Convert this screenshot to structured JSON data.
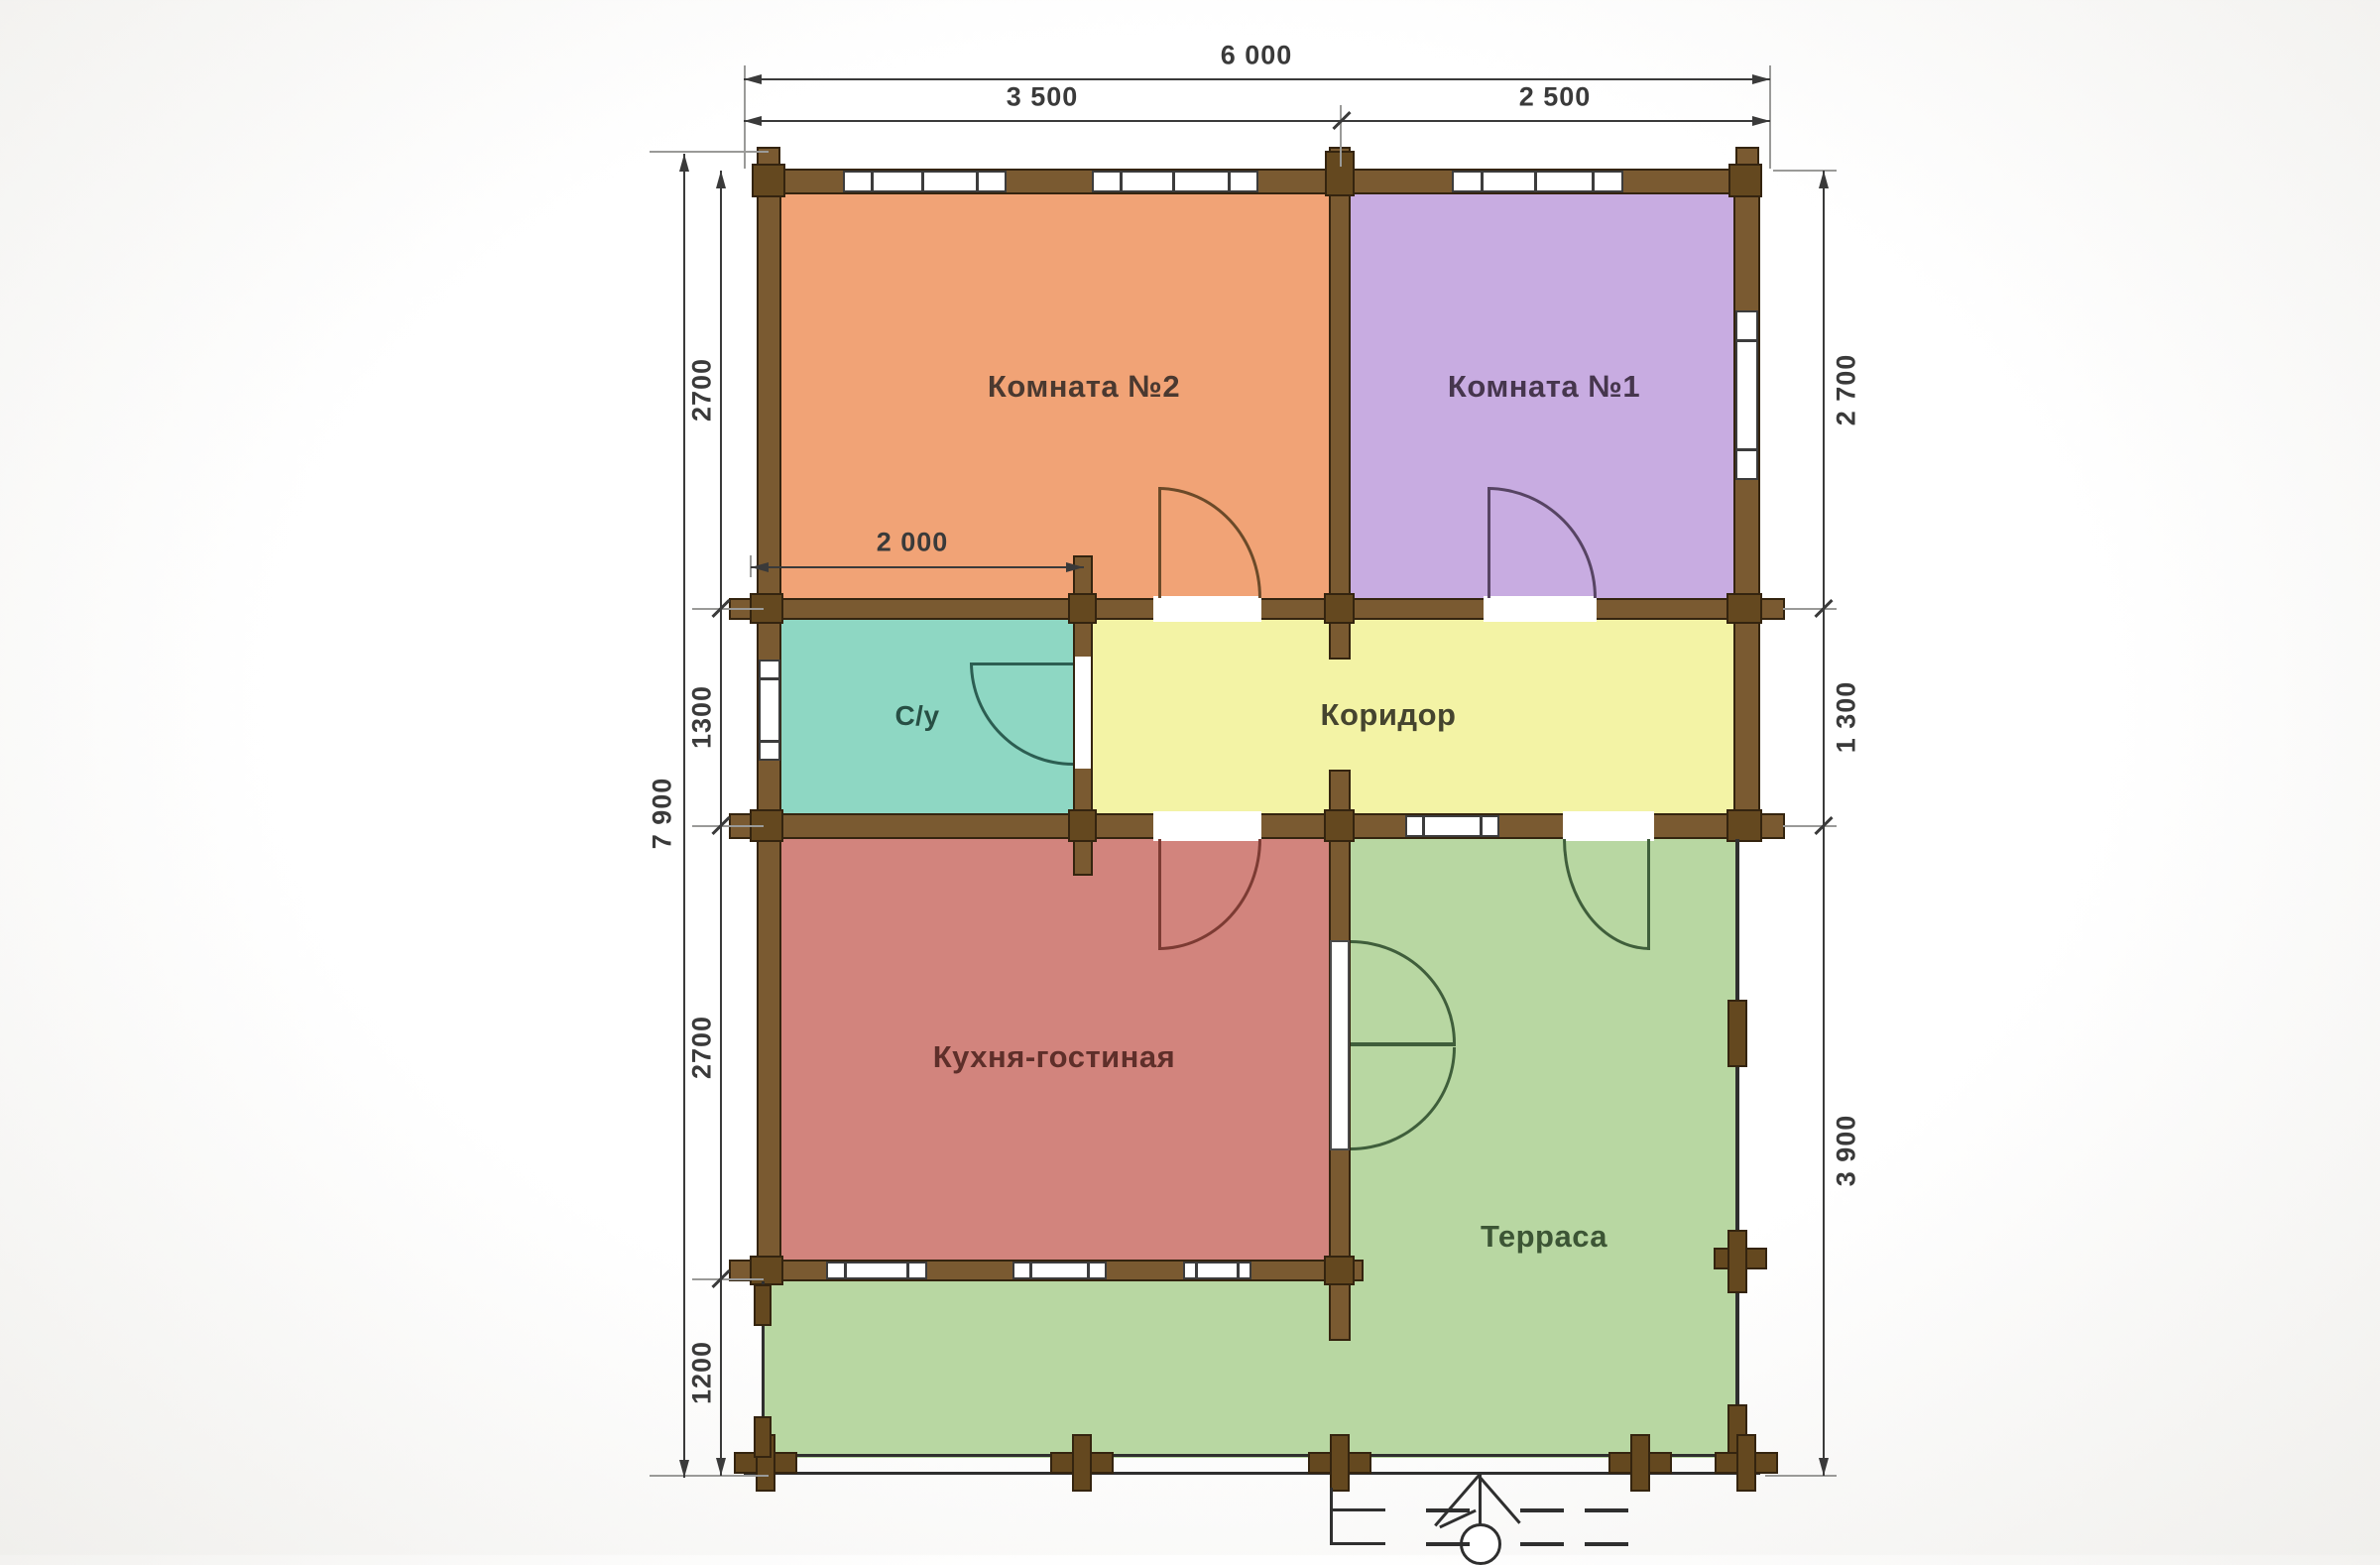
{
  "title": "План дома (floor plan)",
  "rooms": {
    "room2": {
      "label": "Комната №2",
      "color": "#f1a376",
      "label_color": "#4a3930",
      "door_color": "#6b4a29"
    },
    "room1": {
      "label": "Комната №1",
      "color": "#c8ace1",
      "label_color": "#46364d",
      "door_color": "#574463"
    },
    "su": {
      "label": "С/у",
      "color": "#8ed7c3",
      "label_color": "#274f44",
      "door_color": "#2c5e52"
    },
    "corridor": {
      "label": "Коридор",
      "color": "#f3f3a5",
      "label_color": "#45442f",
      "door_color": "#6a6a3a"
    },
    "kitchen": {
      "label": "Кухня-гостиная",
      "color": "#d2847d",
      "label_color": "#5e2f2a",
      "door_color": "#7c3b33"
    },
    "terrace": {
      "label": "Терраса",
      "color": "#b8d7a2",
      "label_color": "#3c5535",
      "door_color": "#3f5e3b"
    }
  },
  "dimensions": {
    "top_total": "6 000",
    "top_left": "3 500",
    "top_right": "2 500",
    "su_width": "2 000",
    "left_total": "7 900",
    "left_segments": [
      "2700",
      "1300",
      "2700",
      "1200"
    ],
    "right_segments": [
      "2 700",
      "1 300",
      "3 900"
    ]
  },
  "colors": {
    "wall": "#7a5a31",
    "walldark": "#64481f",
    "outline": "#34240f",
    "dim": "#3a3a3a"
  }
}
